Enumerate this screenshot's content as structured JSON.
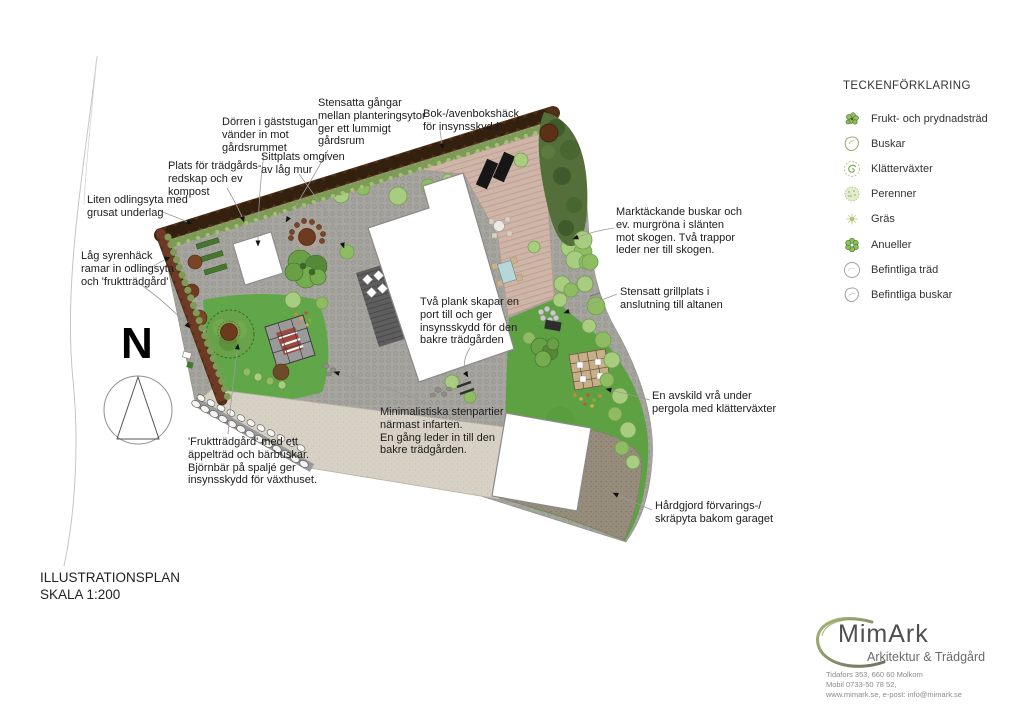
{
  "legend": {
    "title": "TECKENFÖRKLARING",
    "items": [
      {
        "label": "Frukt- och prydnadsträd",
        "icon": "fruit-tree-symbol"
      },
      {
        "label": "Buskar",
        "icon": "shrub-symbol"
      },
      {
        "label": "Klätterväxter",
        "icon": "climber-symbol"
      },
      {
        "label": "Perenner",
        "icon": "perennial-symbol"
      },
      {
        "label": "Gräs",
        "icon": "grass-symbol"
      },
      {
        "label": "Anueller",
        "icon": "annual-symbol"
      },
      {
        "label": "Befintliga träd",
        "icon": "existing-tree-symbol"
      },
      {
        "label": "Befintliga buskar",
        "icon": "existing-shrub-symbol"
      }
    ]
  },
  "annotations": [
    {
      "id": "guesthouse-door",
      "text": "Dörren i gäststugan\nvänder in mot\ngårdsrummet"
    },
    {
      "id": "stone-paths",
      "text": "Stensatta gångar\nmellan planteringsytor\nger ett lummigt\ngårdsrum"
    },
    {
      "id": "beech-hedge",
      "text": "Bok-/avenbokshäck\nför insynsskydd"
    },
    {
      "id": "seating-wall",
      "text": "Sittplats omgiven\nav låg mur"
    },
    {
      "id": "tool-compost",
      "text": "Plats för trädgårds-\nredskap och ev\nkompost"
    },
    {
      "id": "small-bed",
      "text": "Liten odlingsyta med\ngrusat underlag"
    },
    {
      "id": "lilac-hedge",
      "text": "Låg syrenhäck\nramar in odlingsyta\noch 'fruktträdgård'"
    },
    {
      "id": "ground-cover",
      "text": "Marktäckande buskar och\nev. murgröna i slänten\nmot skogen. Två trappor\nleder ner till skogen."
    },
    {
      "id": "grill-spot",
      "text": "Stensatt grillplats i\nanslutning till altanen"
    },
    {
      "id": "two-planks",
      "text": "Två plank skapar en\nport till och ger\ninsynsskydd för den\nbakre trädgården"
    },
    {
      "id": "pergola-nook",
      "text": "En avskild vrå under\npergola med klätterväxter"
    },
    {
      "id": "minimal-stone",
      "text": "Minimalistiska stenpartier\nnärmast infarten.\nEn gång leder in till den\nbakre trädgården."
    },
    {
      "id": "fruit-garden",
      "text": "'Fruktträdgård' med ett\näppelträd och bärbuskar.\nBjörnbär på spaljé ger\ninsynsskydd för växthuset."
    },
    {
      "id": "storage-yard",
      "text": "Hårdgjord förvarings-/\nskräpyta bakom garaget"
    }
  ],
  "north": {
    "label": "N"
  },
  "titleblock": {
    "line1": "ILLUSTRATIONSPLAN",
    "line2": "SKALA 1:200"
  },
  "logo": {
    "name": "MimArk",
    "tagline": "Arkitektur & Trädgård",
    "contact": "Tidafors 353, 660 60 Molkom\nMobil 0733-50 78 52,\nwww.mimark.se, e-post: info@mimark.se"
  },
  "colors": {
    "paving": "#a7a5a0",
    "hedge_brown": "#4f3018",
    "hedge_green": "#7d9b55",
    "lawn": "#5ea243",
    "deck": "#cfb5a8",
    "driveway": "#d6d1c4",
    "hard_surface": "#968c7c",
    "forest": "#546f39",
    "building": "#ffffff",
    "terrace_dark": "#5e5e5e"
  }
}
